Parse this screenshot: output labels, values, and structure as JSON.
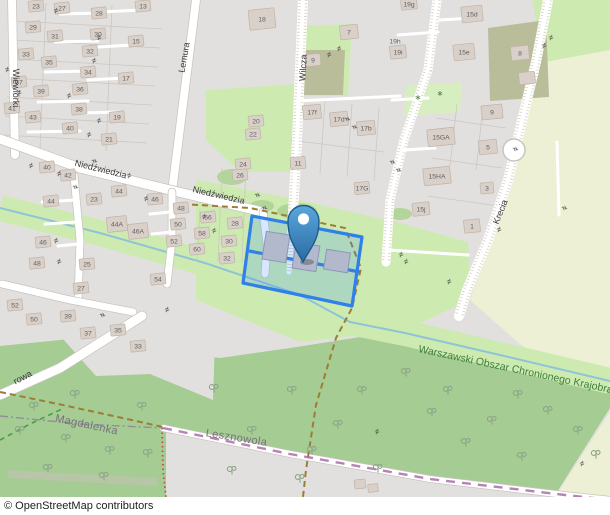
{
  "attribution": "© OpenStreetMap contributors",
  "colors": {
    "residential": "#e2e0de",
    "grass": "#cdebb0",
    "forest": "#a5cc93",
    "farmland": "#eef0d5",
    "allotment": "#b9bd9a",
    "nursery": "#d7eec0",
    "water": "#8fc3d6",
    "selection": "#2f80e8",
    "protected_text": "#3e7d3f"
  },
  "map": {
    "street_labels": [
      {
        "t": "Wiewiórki",
        "x": 13,
        "y": 88,
        "r": 90
      },
      {
        "t": "Lemura",
        "x": 187,
        "y": 58,
        "r": -80
      },
      {
        "t": "Wilcza",
        "x": 306,
        "y": 68,
        "r": -87
      },
      {
        "t": "Niedźwiedzia",
        "x": 100,
        "y": 172,
        "r": 14
      },
      {
        "t": "Niedźwiedzia",
        "x": 218,
        "y": 198,
        "r": 13
      },
      {
        "t": "Krecia",
        "x": 503,
        "y": 213,
        "r": -68
      },
      {
        "t": "rowa",
        "x": 24,
        "y": 380,
        "r": -28
      }
    ],
    "place_labels": [
      {
        "t": "Magdalenka",
        "x": 86,
        "y": 428,
        "r": 12
      },
      {
        "t": "Lesznowola",
        "x": 236,
        "y": 441,
        "r": 9
      }
    ],
    "area_label": {
      "t": "Warszawski Obszar Chronionego Krajobra",
      "x": 418,
      "y": 352,
      "r": 12
    },
    "houses": [
      {
        "t": "23",
        "x": 36,
        "y": 6
      },
      {
        "t": "27",
        "x": 62,
        "y": 8
      },
      {
        "t": "28",
        "x": 99,
        "y": 13
      },
      {
        "t": "29",
        "x": 33,
        "y": 27
      },
      {
        "t": "31",
        "x": 55,
        "y": 36
      },
      {
        "t": "30",
        "x": 98,
        "y": 34
      },
      {
        "t": "33",
        "x": 26,
        "y": 54
      },
      {
        "t": "35",
        "x": 49,
        "y": 62
      },
      {
        "t": "32",
        "x": 90,
        "y": 51
      },
      {
        "t": "34",
        "x": 88,
        "y": 72
      },
      {
        "t": "37",
        "x": 19,
        "y": 82
      },
      {
        "t": "39",
        "x": 41,
        "y": 91
      },
      {
        "t": "36",
        "x": 80,
        "y": 89
      },
      {
        "t": "41",
        "x": 12,
        "y": 108
      },
      {
        "t": "43",
        "x": 33,
        "y": 117
      },
      {
        "t": "38",
        "x": 79,
        "y": 109
      },
      {
        "t": "40",
        "x": 70,
        "y": 128
      },
      {
        "t": "13",
        "x": 143,
        "y": 6
      },
      {
        "t": "15",
        "x": 136,
        "y": 41
      },
      {
        "t": "17",
        "x": 126,
        "y": 78
      },
      {
        "t": "19",
        "x": 117,
        "y": 117
      },
      {
        "t": "21",
        "x": 109,
        "y": 139
      },
      {
        "t": "18",
        "x": 262,
        "y": 19,
        "w": 26,
        "h": 20
      },
      {
        "t": "20",
        "x": 256,
        "y": 121
      },
      {
        "t": "22",
        "x": 253,
        "y": 134
      },
      {
        "t": "24",
        "x": 243,
        "y": 164
      },
      {
        "t": "26",
        "x": 240,
        "y": 175
      },
      {
        "t": "7",
        "x": 349,
        "y": 32,
        "w": 18,
        "h": 14
      },
      {
        "t": "9",
        "x": 313,
        "y": 60,
        "w": 15,
        "h": 12
      },
      {
        "t": "19g",
        "x": 409,
        "y": 4,
        "w": 16,
        "h": 11
      },
      {
        "t": "19h",
        "x": 395,
        "y": 41,
        "nb": 1
      },
      {
        "t": "19i",
        "x": 398,
        "y": 52,
        "w": 16,
        "h": 13
      },
      {
        "t": "15d",
        "x": 472,
        "y": 14,
        "w": 21,
        "h": 16
      },
      {
        "t": "15e",
        "x": 464,
        "y": 52,
        "w": 21,
        "h": 16
      },
      {
        "t": "8",
        "x": 520,
        "y": 53,
        "w": 18,
        "h": 14
      },
      {
        "t": null,
        "x": 527,
        "y": 78,
        "w": 16,
        "h": 12
      },
      {
        "t": "9",
        "x": 492,
        "y": 112,
        "w": 21,
        "h": 14
      },
      {
        "t": "5",
        "x": 488,
        "y": 147,
        "w": 18,
        "h": 14
      },
      {
        "t": "15GA",
        "x": 441,
        "y": 137,
        "w": 27,
        "h": 17
      },
      {
        "t": "15HA",
        "x": 437,
        "y": 176,
        "w": 27,
        "h": 17
      },
      {
        "t": "15j",
        "x": 421,
        "y": 209,
        "w": 17,
        "h": 13
      },
      {
        "t": "3",
        "x": 487,
        "y": 188,
        "w": 13,
        "h": 11
      },
      {
        "t": "1",
        "x": 472,
        "y": 226,
        "w": 16,
        "h": 13
      },
      {
        "t": "17f",
        "x": 312,
        "y": 112,
        "w": 18,
        "h": 14
      },
      {
        "t": "17d",
        "x": 339,
        "y": 119,
        "w": 18,
        "h": 14
      },
      {
        "t": "17b",
        "x": 366,
        "y": 128,
        "w": 18,
        "h": 14
      },
      {
        "t": "11",
        "x": 298,
        "y": 163,
        "w": 15,
        "h": 12
      },
      {
        "t": "17G",
        "x": 362,
        "y": 188,
        "w": 15,
        "h": 12
      },
      {
        "t": "40",
        "x": 47,
        "y": 167
      },
      {
        "t": "42",
        "x": 68,
        "y": 175
      },
      {
        "t": "44",
        "x": 51,
        "y": 201
      },
      {
        "t": "23",
        "x": 94,
        "y": 199
      },
      {
        "t": "44",
        "x": 119,
        "y": 191
      },
      {
        "t": "46",
        "x": 155,
        "y": 199
      },
      {
        "t": "48",
        "x": 181,
        "y": 208
      },
      {
        "t": "44A",
        "x": 117,
        "y": 224,
        "w": 20,
        "h": 15
      },
      {
        "t": "46A",
        "x": 138,
        "y": 231,
        "w": 20,
        "h": 15
      },
      {
        "t": "50",
        "x": 178,
        "y": 224
      },
      {
        "t": "52",
        "x": 174,
        "y": 241
      },
      {
        "t": "56",
        "x": 208,
        "y": 217
      },
      {
        "t": "58",
        "x": 202,
        "y": 233
      },
      {
        "t": "60",
        "x": 197,
        "y": 249
      },
      {
        "t": "46",
        "x": 43,
        "y": 242
      },
      {
        "t": "48",
        "x": 37,
        "y": 263
      },
      {
        "t": "25",
        "x": 87,
        "y": 264
      },
      {
        "t": "27",
        "x": 81,
        "y": 288
      },
      {
        "t": "54",
        "x": 158,
        "y": 279
      },
      {
        "t": "28",
        "x": 235,
        "y": 223
      },
      {
        "t": "30",
        "x": 229,
        "y": 241
      },
      {
        "t": "32",
        "x": 227,
        "y": 258
      },
      {
        "t": "52",
        "x": 15,
        "y": 305
      },
      {
        "t": "50",
        "x": 34,
        "y": 319
      },
      {
        "t": "39",
        "x": 68,
        "y": 316
      },
      {
        "t": "37",
        "x": 88,
        "y": 333
      },
      {
        "t": "35",
        "x": 118,
        "y": 330
      },
      {
        "t": "33",
        "x": 138,
        "y": 346
      },
      {
        "t": null,
        "x": 360,
        "y": 484,
        "w": 11,
        "h": 9
      },
      {
        "t": null,
        "x": 373,
        "y": 488,
        "w": 10,
        "h": 8
      }
    ],
    "trees": [
      [
        20,
        432
      ],
      [
        48,
        470
      ],
      [
        75,
        396
      ],
      [
        34,
        408
      ],
      [
        110,
        452
      ],
      [
        142,
        408
      ],
      [
        104,
        478
      ],
      [
        66,
        440
      ],
      [
        148,
        455
      ],
      [
        214,
        390
      ],
      [
        252,
        432
      ],
      [
        232,
        472
      ],
      [
        292,
        392
      ],
      [
        312,
        452
      ],
      [
        338,
        426
      ],
      [
        362,
        392
      ],
      [
        378,
        470
      ],
      [
        300,
        480
      ],
      [
        406,
        374
      ],
      [
        432,
        414
      ],
      [
        466,
        444
      ],
      [
        448,
        392
      ],
      [
        492,
        422
      ],
      [
        518,
        396
      ],
      [
        548,
        412
      ],
      [
        578,
        432
      ],
      [
        596,
        456
      ],
      [
        522,
        458
      ]
    ],
    "shrubs": [
      [
        418,
        100
      ],
      [
        440,
        96
      ]
    ],
    "gates": [
      [
        57,
        13,
        -20
      ],
      [
        100,
        40,
        -20
      ],
      [
        8,
        72,
        -15
      ],
      [
        20,
        95,
        -15
      ],
      [
        95,
        63,
        -20
      ],
      [
        70,
        98,
        -20
      ],
      [
        100,
        123,
        -20
      ],
      [
        90,
        137,
        -20
      ],
      [
        32,
        168,
        -20
      ],
      [
        60,
        176,
        -20
      ],
      [
        73,
        188,
        70
      ],
      [
        92,
        162,
        70
      ],
      [
        130,
        178,
        -20
      ],
      [
        147,
        201,
        -20
      ],
      [
        205,
        219,
        -20
      ],
      [
        215,
        233,
        -20
      ],
      [
        57,
        243,
        -20
      ],
      [
        60,
        264,
        -20
      ],
      [
        255,
        196,
        70
      ],
      [
        262,
        209,
        70
      ],
      [
        298,
        236,
        70
      ],
      [
        330,
        57,
        -20
      ],
      [
        340,
        51,
        -20
      ],
      [
        345,
        120,
        70
      ],
      [
        352,
        128,
        70
      ],
      [
        390,
        163,
        70
      ],
      [
        396,
        171,
        70
      ],
      [
        402,
        257,
        -20
      ],
      [
        407,
        264,
        -20
      ],
      [
        450,
        284,
        -20
      ],
      [
        545,
        48,
        -20
      ],
      [
        552,
        40,
        -20
      ],
      [
        513,
        150,
        70
      ],
      [
        562,
        209,
        70
      ],
      [
        500,
        232,
        -20
      ],
      [
        168,
        312,
        -20
      ],
      [
        100,
        316,
        70
      ],
      [
        378,
        434,
        -20
      ],
      [
        583,
        466,
        -20
      ]
    ],
    "bushes": [
      {
        "x": 232,
        "y": 177,
        "rx": 15,
        "ry": 8
      },
      {
        "x": 262,
        "y": 206,
        "rx": 12,
        "ry": 6
      },
      {
        "x": 297,
        "y": 211,
        "rx": 20,
        "ry": 8
      },
      {
        "x": 400,
        "y": 214,
        "rx": 12,
        "ry": 6
      }
    ]
  },
  "marker": {
    "name": "location-pin"
  },
  "selection": {
    "name": "selected-parcel"
  }
}
